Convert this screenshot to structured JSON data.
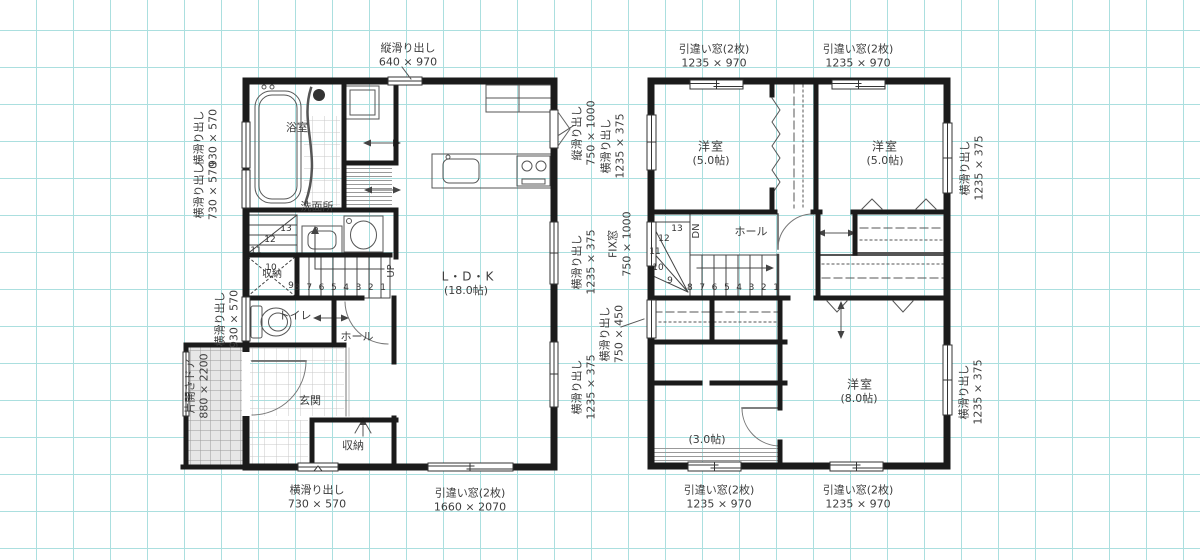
{
  "colors": {
    "grid": "#abdfdf",
    "wall": "#1b1b1b",
    "porch_fill": "#e7e7e7",
    "text": "#3d3d3d"
  },
  "floor1": {
    "rooms": {
      "bath": "浴室",
      "washroom": "洗面所",
      "stair_closet": "収納",
      "toilet": "トイレ",
      "hall": "ホール",
      "entrance": "玄関",
      "entrance_closet": "収納",
      "ldk": "L・D・K",
      "ldk_size": "(18.0帖)",
      "up": "UP"
    },
    "stairs": {
      "run": [
        "8",
        "7",
        "6",
        "5",
        "4",
        "3",
        "2",
        "1"
      ],
      "winder": [
        "13",
        "12",
        "11",
        "10",
        "9"
      ]
    },
    "windows": {
      "top": {
        "name": "縦滑り出し",
        "size": "640 × 970"
      },
      "left_upper": {
        "name": "横滑り出し",
        "size": "930 × 570"
      },
      "left_lower": {
        "name": "横滑り出し",
        "size": "730 × 570"
      },
      "left_toilet": {
        "name": "横滑り出し",
        "size": "930 × 570"
      },
      "entry_door": {
        "name": "片開きドア",
        "size": "880 × 2200"
      },
      "bottom_small": {
        "name": "横滑り出し",
        "size": "730 × 570"
      },
      "bottom_wide": {
        "name": "引違い窓(2枚)",
        "size": "1660 × 2070"
      },
      "right_top": {
        "name": "縦滑り出し",
        "size": "750 × 1000"
      },
      "right_mid": {
        "name": "横滑り出し",
        "size": "1235 × 375"
      },
      "right_low": {
        "name": "横滑り出し",
        "size": "1235 × 375"
      }
    }
  },
  "floor2": {
    "rooms": {
      "bed1": "洋室",
      "bed1_size": "(5.0帖)",
      "bed2": "洋室",
      "bed2_size": "(5.0帖)",
      "hall": "ホール",
      "dn": "DN",
      "bed3": "洋室",
      "bed3_size": "(8.0帖)",
      "storage": "(3.0帖)"
    },
    "stairs": {
      "run": [
        "8",
        "7",
        "6",
        "5",
        "4",
        "3",
        "2",
        "1"
      ],
      "winder": [
        "13",
        "12",
        "11",
        "10",
        "9"
      ]
    },
    "windows": {
      "top_left": {
        "name": "引違い窓(2枚)",
        "size": "1235 × 970"
      },
      "top_right": {
        "name": "引違い窓(2枚)",
        "size": "1235 × 970"
      },
      "west_top": {
        "name": "横滑り出し",
        "size": "1235 × 375"
      },
      "west_mid": {
        "name": "FIX窓",
        "size": "750 × 1000"
      },
      "west_low": {
        "name": "横滑り出し",
        "size": "750 × 450"
      },
      "east_top": {
        "name": "横滑り出し",
        "size": "1235 × 375"
      },
      "east_low": {
        "name": "横滑り出し",
        "size": "1235 × 375"
      },
      "bottom_left": {
        "name": "引違い窓(2枚)",
        "size": "1235 × 970"
      },
      "bottom_right": {
        "name": "引違い窓(2枚)",
        "size": "1235 × 970"
      }
    }
  }
}
